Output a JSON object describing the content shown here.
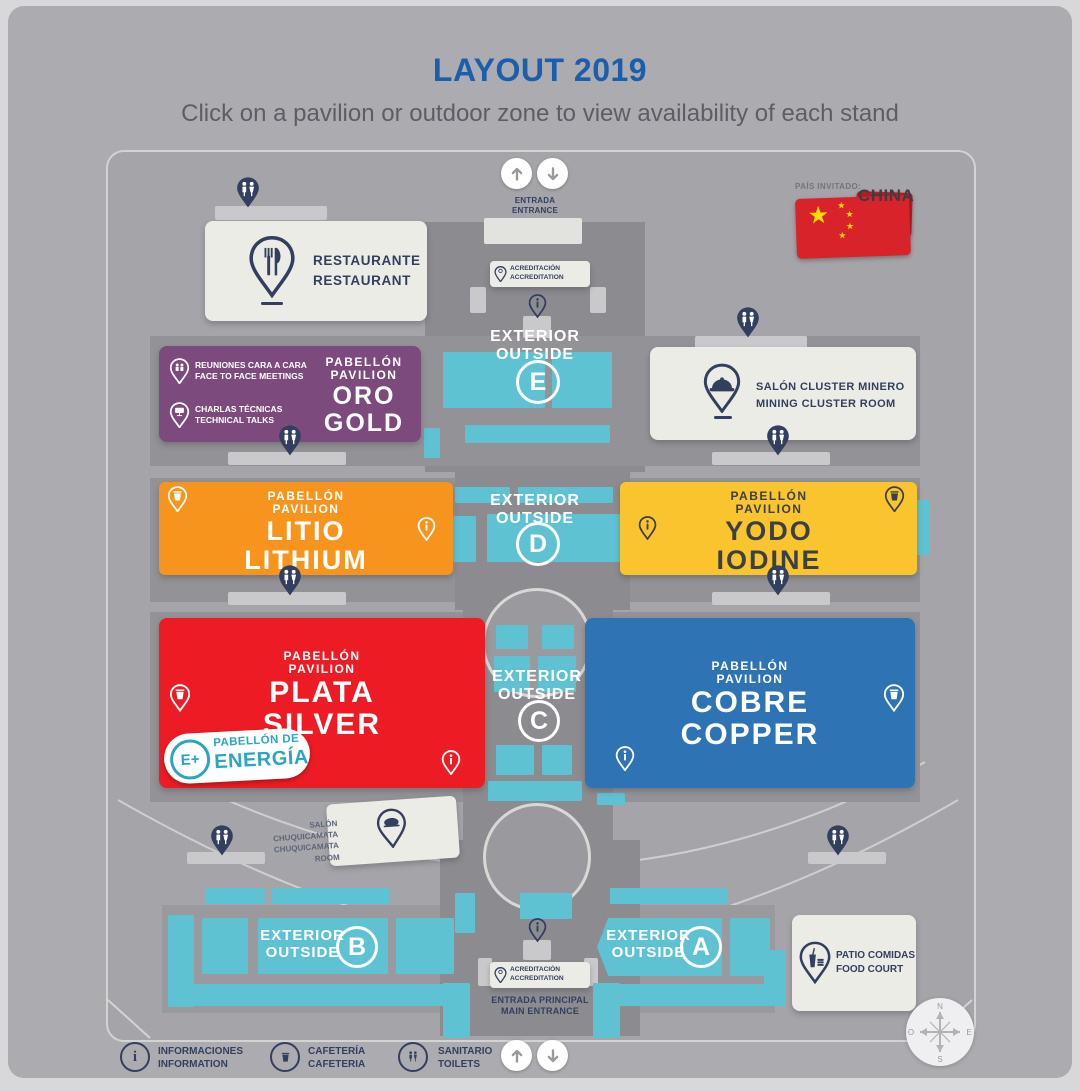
{
  "title": "LAYOUT 2019",
  "subtitle": "Click on a pavilion or outdoor zone to view availability of each stand",
  "guest_country": {
    "label": "PAÍS INVITADO:",
    "name": "CHINA"
  },
  "entrance_top": {
    "line1": "ENTRADA",
    "line2": "ENTRANCE"
  },
  "accreditation": {
    "line1": "ACREDITACIÓN",
    "line2": "ACCREDITATION"
  },
  "main_entrance": {
    "line1": "ENTRADA PRINCIPAL",
    "line2": "MAIN ENTRANCE"
  },
  "restaurant": {
    "line1": "RESTAURANTE",
    "line2": "RESTAURANT"
  },
  "mining_cluster": {
    "line1": "SALÓN CLUSTER MINERO",
    "line2": "MINING CLUSTER ROOM"
  },
  "chuquicamata": {
    "line1": "SALÓN CHUQUICAMATA",
    "line2": "CHUQUICAMATA ROOM"
  },
  "food_court": {
    "line1": "PATIO COMIDAS",
    "line2": "FOOD COURT"
  },
  "pavilions": {
    "gold": {
      "label1": "PABELLÓN",
      "label2": "PAVILION",
      "name_es": "ORO",
      "name_en": "GOLD",
      "meetings1": "REUNIONES CARA A CARA",
      "meetings2": "FACE TO FACE MEETINGS",
      "talks1": "CHARLAS TÉCNICAS",
      "talks2": "TECHNICAL TALKS",
      "color": "#7c4a7d"
    },
    "lithium": {
      "label1": "PABELLÓN",
      "label2": "PAVILION",
      "name_es": "LITIO",
      "name_en": "LITHIUM",
      "color": "#f7941e"
    },
    "iodine": {
      "label1": "PABELLÓN",
      "label2": "PAVILION",
      "name_es": "YODO",
      "name_en": "IODINE",
      "color": "#f9c42e"
    },
    "silver": {
      "label1": "PABELLÓN",
      "label2": "PAVILION",
      "name_es": "PLATA",
      "name_en": "SILVER",
      "color": "#ed1c24"
    },
    "copper": {
      "label1": "PABELLÓN",
      "label2": "PAVILION",
      "name_es": "COBRE",
      "name_en": "COPPER",
      "color": "#2e74b5"
    }
  },
  "energy": {
    "badge": "E+",
    "line1": "PABELLÓN DE",
    "line2": "ENERGÍA",
    "color": "#2aa6c0"
  },
  "exterior": {
    "word1": "EXTERIOR",
    "word2": "OUTSIDE",
    "zones": {
      "e": "E",
      "d": "D",
      "c": "C",
      "b": "B",
      "a": "A"
    }
  },
  "legend": {
    "information": {
      "line1": "INFORMACIONES",
      "line2": "INFORMATION"
    },
    "cafeteria": {
      "line1": "CAFETERÍA",
      "line2": "CAFETERIA"
    },
    "toilets": {
      "line1": "SANITARIO",
      "line2": "TOILETS"
    }
  },
  "compass": {
    "n": "N",
    "s": "S",
    "e": "E",
    "o": "O"
  },
  "colors": {
    "stand_cyan": "#5fc2d3",
    "navy": "#333f5e",
    "accent_blue": "#1a5eae"
  }
}
